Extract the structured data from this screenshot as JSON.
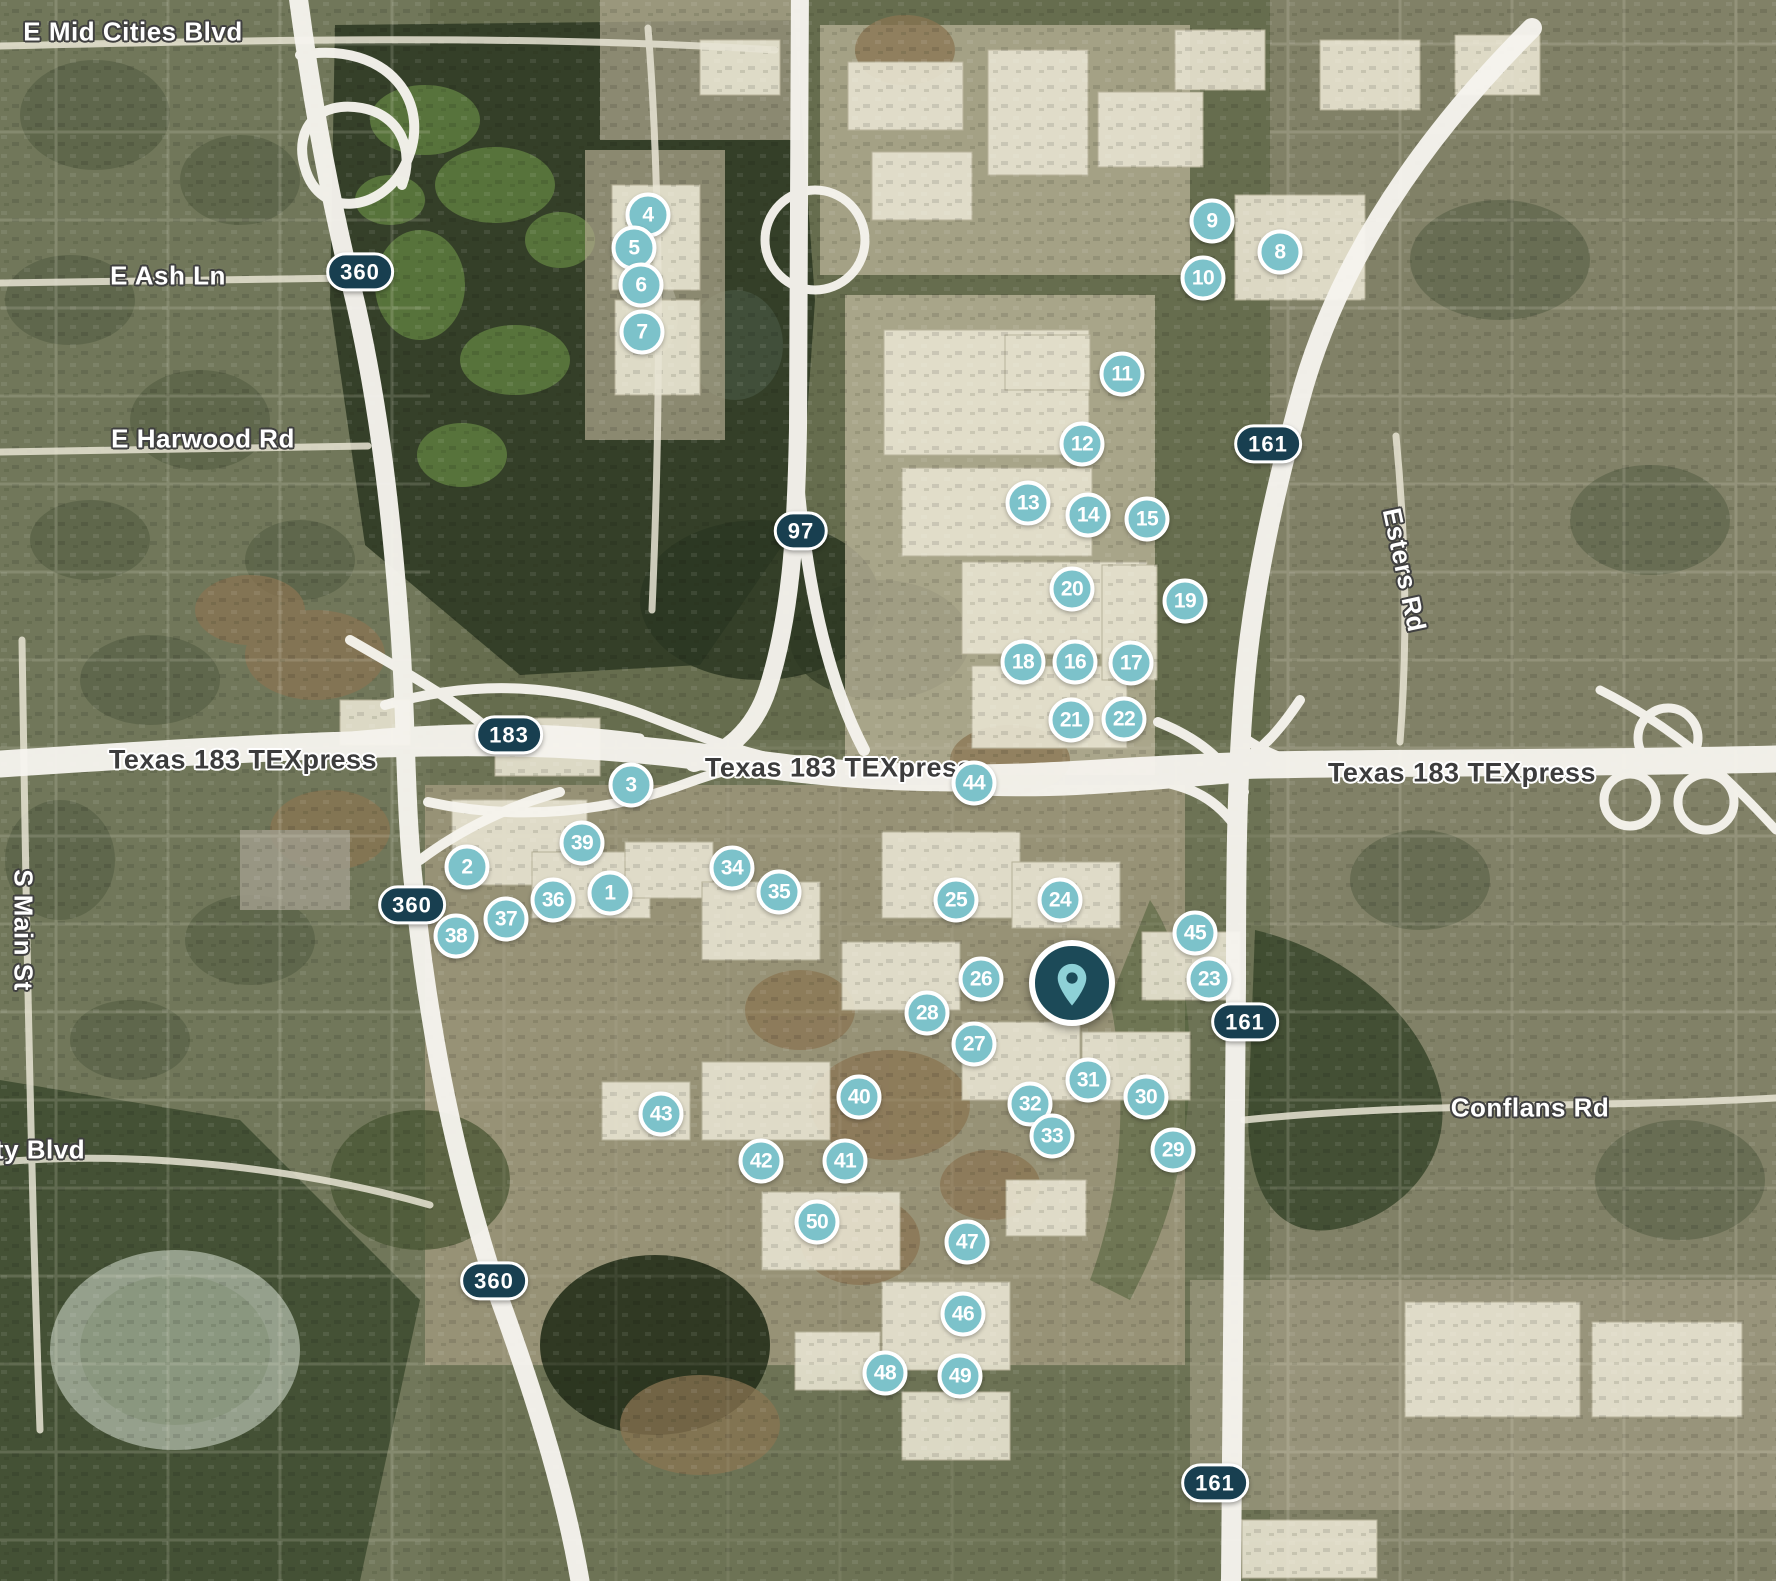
{
  "map": {
    "colors": {
      "marker_fill": "#7cc2ca",
      "marker_border": "#ffffff",
      "marker_text": "#ffffff",
      "shield_fill": "#183f50",
      "shield_text": "#ffffff",
      "pin_fill": "#1c4a58",
      "pin_glyph": "#8ed1d7",
      "road_label_text": "#ffffff",
      "highway_label_text": "#3c3c3c"
    },
    "pin": {
      "x": 1072,
      "y": 983
    },
    "markers": [
      {
        "n": 1,
        "x": 610,
        "y": 893
      },
      {
        "n": 2,
        "x": 467,
        "y": 867
      },
      {
        "n": 3,
        "x": 631,
        "y": 785
      },
      {
        "n": 4,
        "x": 648,
        "y": 215
      },
      {
        "n": 5,
        "x": 634,
        "y": 248
      },
      {
        "n": 6,
        "x": 641,
        "y": 285
      },
      {
        "n": 7,
        "x": 642,
        "y": 332
      },
      {
        "n": 8,
        "x": 1280,
        "y": 252
      },
      {
        "n": 9,
        "x": 1212,
        "y": 221
      },
      {
        "n": 10,
        "x": 1203,
        "y": 278
      },
      {
        "n": 11,
        "x": 1122,
        "y": 374
      },
      {
        "n": 12,
        "x": 1082,
        "y": 444
      },
      {
        "n": 13,
        "x": 1028,
        "y": 503
      },
      {
        "n": 14,
        "x": 1088,
        "y": 515
      },
      {
        "n": 15,
        "x": 1147,
        "y": 519
      },
      {
        "n": 16,
        "x": 1075,
        "y": 662
      },
      {
        "n": 17,
        "x": 1131,
        "y": 663
      },
      {
        "n": 18,
        "x": 1023,
        "y": 662
      },
      {
        "n": 19,
        "x": 1185,
        "y": 601
      },
      {
        "n": 20,
        "x": 1072,
        "y": 589
      },
      {
        "n": 21,
        "x": 1071,
        "y": 720
      },
      {
        "n": 22,
        "x": 1124,
        "y": 719
      },
      {
        "n": 23,
        "x": 1209,
        "y": 979
      },
      {
        "n": 24,
        "x": 1060,
        "y": 900
      },
      {
        "n": 25,
        "x": 956,
        "y": 900
      },
      {
        "n": 26,
        "x": 981,
        "y": 979
      },
      {
        "n": 27,
        "x": 974,
        "y": 1044
      },
      {
        "n": 28,
        "x": 927,
        "y": 1013
      },
      {
        "n": 29,
        "x": 1173,
        "y": 1150
      },
      {
        "n": 30,
        "x": 1146,
        "y": 1097
      },
      {
        "n": 31,
        "x": 1088,
        "y": 1080
      },
      {
        "n": 32,
        "x": 1030,
        "y": 1104
      },
      {
        "n": 33,
        "x": 1052,
        "y": 1136
      },
      {
        "n": 34,
        "x": 732,
        "y": 868
      },
      {
        "n": 35,
        "x": 779,
        "y": 892
      },
      {
        "n": 36,
        "x": 553,
        "y": 900
      },
      {
        "n": 37,
        "x": 506,
        "y": 919
      },
      {
        "n": 38,
        "x": 456,
        "y": 936
      },
      {
        "n": 39,
        "x": 582,
        "y": 843
      },
      {
        "n": 40,
        "x": 859,
        "y": 1097
      },
      {
        "n": 41,
        "x": 845,
        "y": 1161
      },
      {
        "n": 42,
        "x": 761,
        "y": 1161
      },
      {
        "n": 43,
        "x": 661,
        "y": 1114
      },
      {
        "n": 44,
        "x": 974,
        "y": 783
      },
      {
        "n": 45,
        "x": 1195,
        "y": 933
      },
      {
        "n": 46,
        "x": 963,
        "y": 1314
      },
      {
        "n": 47,
        "x": 967,
        "y": 1242
      },
      {
        "n": 48,
        "x": 885,
        "y": 1373
      },
      {
        "n": 49,
        "x": 960,
        "y": 1376
      },
      {
        "n": 50,
        "x": 817,
        "y": 1222
      }
    ],
    "shields": [
      {
        "label": "360",
        "x": 360,
        "y": 272
      },
      {
        "label": "97",
        "x": 801,
        "y": 531
      },
      {
        "label": "183",
        "x": 509,
        "y": 735
      },
      {
        "label": "161",
        "x": 1268,
        "y": 444
      },
      {
        "label": "360",
        "x": 412,
        "y": 905
      },
      {
        "label": "161",
        "x": 1245,
        "y": 1022
      },
      {
        "label": "360",
        "x": 494,
        "y": 1281
      },
      {
        "label": "161",
        "x": 1215,
        "y": 1483
      }
    ],
    "road_labels": [
      {
        "text": "E Mid Cities Blvd",
        "x": 133,
        "y": 32
      },
      {
        "text": "E Ash Ln",
        "x": 168,
        "y": 276
      },
      {
        "text": "E Harwood Rd",
        "x": 203,
        "y": 439
      },
      {
        "text": "S Main St",
        "x": 23,
        "y": 930,
        "rotate": 90
      },
      {
        "text": "ty Blvd",
        "x": 40,
        "y": 1150
      },
      {
        "text": "Esters Rd",
        "x": 1404,
        "y": 570,
        "rotate": 78
      },
      {
        "text": "Conflans Rd",
        "x": 1530,
        "y": 1108
      }
    ],
    "highway_labels": [
      {
        "text": "Texas 183 TEXpress",
        "x": 243,
        "y": 760
      },
      {
        "text": "Texas 183 TEXpress",
        "x": 839,
        "y": 768
      },
      {
        "text": "Texas 183 TEXpress",
        "x": 1462,
        "y": 773
      }
    ]
  }
}
